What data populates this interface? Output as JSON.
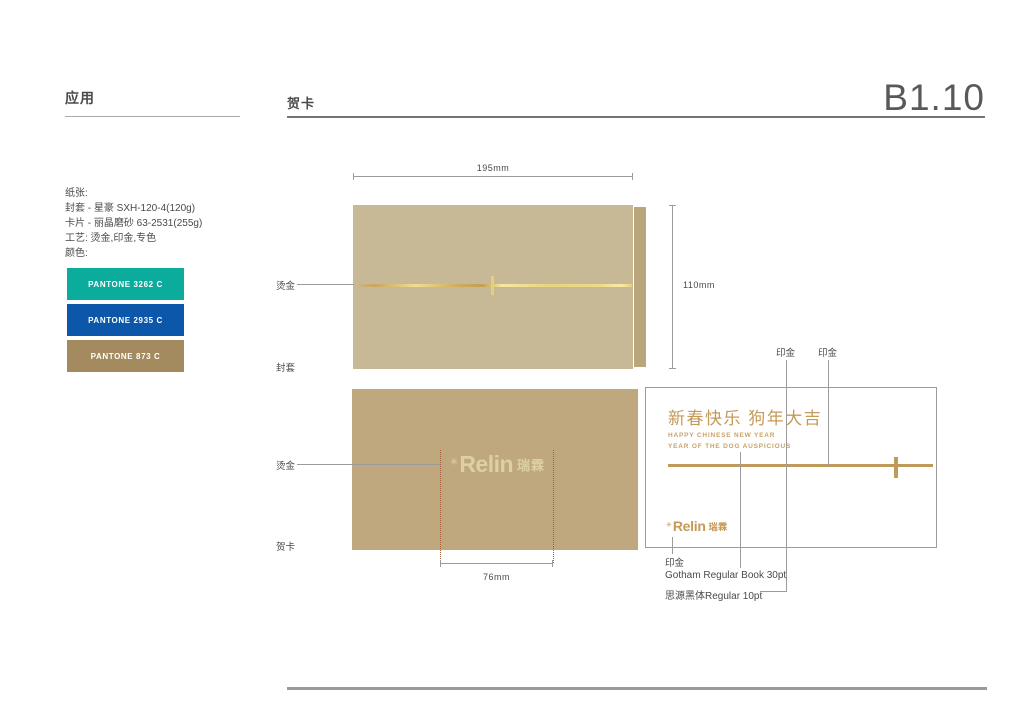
{
  "header": {
    "section_title": "应用",
    "page_title": "贺卡",
    "page_code": "B1.10"
  },
  "specs": {
    "lines": [
      "纸张:",
      "封套 - 星豪 SXH-120-4(120g)",
      "卡片 - 丽晶磨砂 63-2531(255g)",
      "工艺: 烫金,印金,专色",
      "颜色:"
    ]
  },
  "swatches": [
    {
      "name": "PANTONE 3262 C",
      "hex": "#0cac9c"
    },
    {
      "name": "PANTONE 2935 C",
      "hex": "#0c57a9"
    },
    {
      "name": "PANTONE 873 C",
      "hex": "#a48b5f"
    }
  ],
  "brand": {
    "mark": "✳",
    "latin": "Relin",
    "cjk": "瑞霖"
  },
  "envelope": {
    "width_label": "195mm",
    "height_label": "110mm",
    "process_label": "烫金",
    "name_label": "封套",
    "body_color": "#c8b996",
    "flap_color": "#b9a67c"
  },
  "card_front": {
    "process_label": "烫金",
    "name_label": "贺卡",
    "logo_width_label": "76mm",
    "fill_color": "#bfa87d"
  },
  "card_inner": {
    "greeting_cn": "新春快乐 狗年大吉",
    "greeting_en1": "HAPPY CHINESE NEW YEAR",
    "greeting_en2": "YEAR OF THE DOG AUSPICIOUS",
    "print_gold_label_1": "印金",
    "print_gold_label_2": "印金",
    "print_gold_label_bottom": "印金",
    "font_note_latin": "Gotham Regular Book 30pt",
    "font_note_cjk": "思源黑体Regular  10pt",
    "accent_gold": "#c49a58"
  }
}
